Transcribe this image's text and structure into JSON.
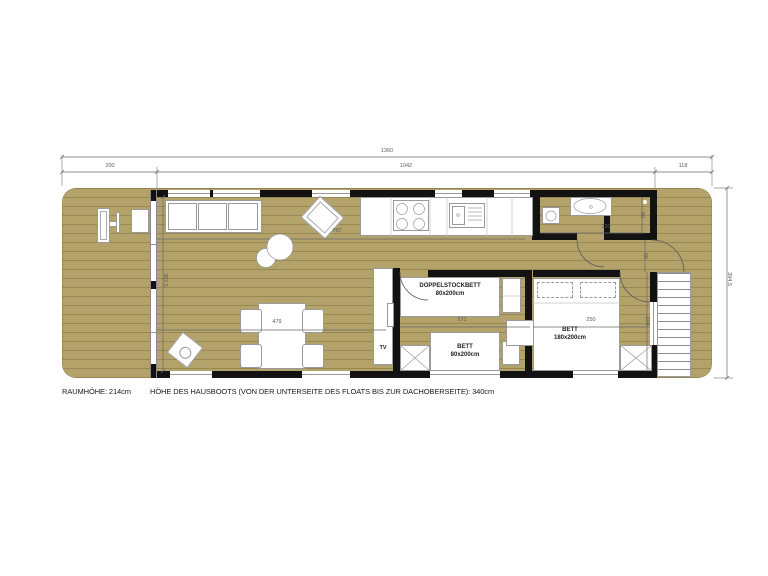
{
  "footer": {
    "room_height": "RAUMHÖHE: 214cm",
    "boat_height": "HÖHE DES HAUSBOOTS (VON DER UNTERSEITE DES FLOATS BIS ZUR DACHOBERSEITE): 340cm"
  },
  "dims": {
    "total_length": "1360",
    "front_deck": "200",
    "cabin_length": "1042",
    "aft_deck": "118",
    "total_width": "394,5",
    "interior_width": "362,5",
    "living_length": "767",
    "dining_length": "479",
    "bunk_room": "271",
    "master_room": "250",
    "bathroom": "230",
    "storage_depth": "60",
    "hall_door": "66",
    "stair_length": "204"
  },
  "rooms": {
    "bunk_bed_line1": "DOPPELSTOCKBETT",
    "bunk_bed_line2": "80x200cm",
    "single_bed_line1": "BETT",
    "single_bed_line2": "80x200cm",
    "double_bed_line1": "BETT",
    "double_bed_line2": "180x200cm",
    "tv": "TV"
  },
  "colors": {
    "floor": "#b3a26a",
    "wall": "#121212",
    "fixture_fill": "#ffffff",
    "fixture_stroke": "#9a9a9a",
    "dimension": "#5a5a5a"
  }
}
